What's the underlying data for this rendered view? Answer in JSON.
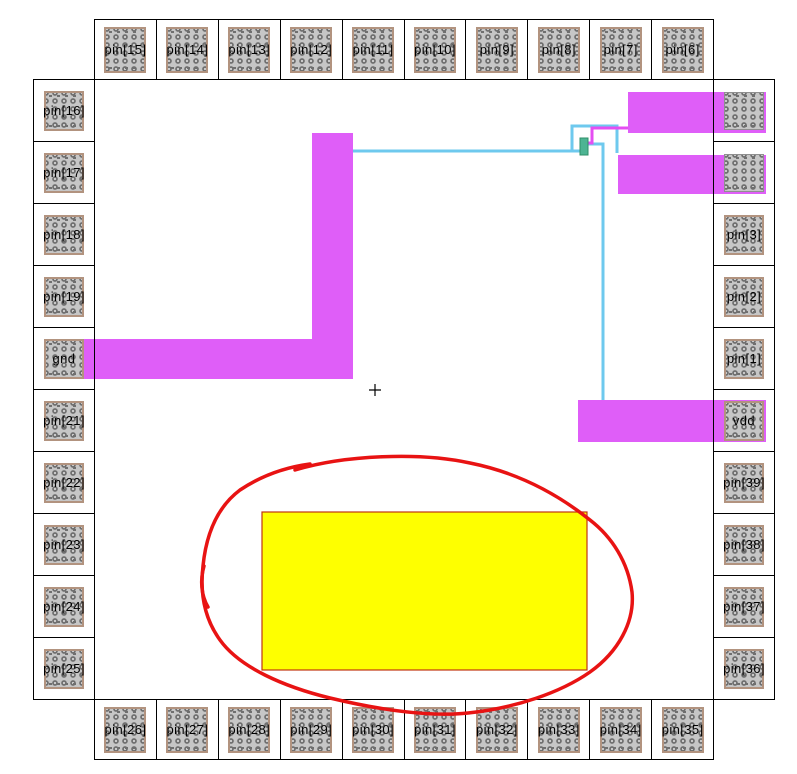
{
  "window": {
    "description": "IC layout pad-ring view with routed metal, a highlighted block and a red freehand annotation",
    "background": "#ffffff"
  },
  "colors": {
    "metal_magenta": "#df5ef8",
    "wire_cyan": "#6ec9ee",
    "wire_magenta": "#e44ef2",
    "via_green": "#4db493",
    "via_border": "#2e8f68",
    "yellow_fill": "#feff00",
    "yellow_border": "#c03511",
    "annotation_red": "#e81313",
    "pad_fill": "#c6c6c6",
    "pad_border": "#b2937f",
    "cell_border": "#000000",
    "cross_black": "#000000"
  },
  "pads": {
    "top": [
      "pin[15]",
      "pin[14]",
      "pin[13]",
      "pin[12]",
      "pin[11]",
      "pin[10]",
      "pin[9]",
      "pin[8]",
      "pin[7]",
      "pin[6]"
    ],
    "bottom": [
      "pin[26]",
      "pin[27]",
      "pin[28]",
      "pin[29]",
      "pin[30]",
      "pin[31]",
      "pin[32]",
      "pin[33]",
      "pin[34]",
      "pin[35]"
    ],
    "left": [
      "pin[16]",
      "pin[17]",
      "pin[18]",
      "pin[19]",
      "gnd",
      "pin[21]",
      "pin[22]",
      "pin[23]",
      "pin[24]",
      "pin[25]"
    ],
    "right": [
      "",
      "",
      "pin[3]",
      "pin[2]",
      "pin[1]",
      "vdd",
      "pin[39]",
      "pin[38]",
      "pin[37]",
      "pin[36]"
    ]
  },
  "shapes": {
    "metal_bars": [
      {
        "name": "gnd-route-vertical",
        "x": 312,
        "y": 133,
        "w": 41,
        "h": 246
      },
      {
        "name": "gnd-route-horizontal",
        "x": 80,
        "y": 339,
        "w": 273,
        "h": 40
      },
      {
        "name": "pad-right-1-stub",
        "x": 628,
        "y": 92,
        "w": 138,
        "h": 41
      },
      {
        "name": "pad-right-2-stub",
        "x": 618,
        "y": 155,
        "w": 148,
        "h": 39
      },
      {
        "name": "vdd-stub",
        "x": 578,
        "y": 400,
        "w": 188,
        "h": 42
      }
    ],
    "cyan_wires": [
      "M352,151 H584",
      "M572,151 V126 H617 V153",
      "M584,144 H603 V401"
    ],
    "magenta_wire": "M584,143 H592 V128 H629",
    "via": {
      "x": 580,
      "y": 138,
      "w": 8,
      "h": 17
    },
    "yellow_rect": {
      "x": 262,
      "y": 512,
      "w": 325,
      "h": 158
    },
    "cross_marker": {
      "cx": 375,
      "cy": 390,
      "arm": 6
    },
    "annotation": {
      "loop_path": "M 295,470 C 345,455 420,452 470,463 C 515,472 555,492 590,520 C 612,537 628,562 632,592 C 635,622 618,652 590,672 C 560,693 515,708 468,713 C 430,717 380,710 330,698 C 285,687 240,668 220,640 C 204,618 200,592 203,566 C 206,536 216,508 240,490 C 258,478 280,468 310,464",
      "tail_path": "M 204,566 C 200,580 201,595 208,607",
      "stroke_width": 3.5
    }
  }
}
